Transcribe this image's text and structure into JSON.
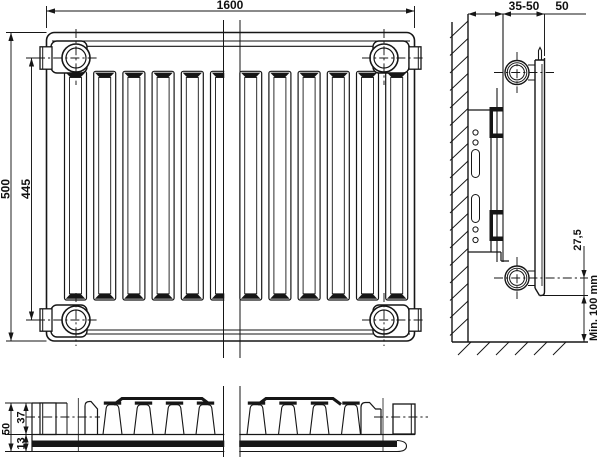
{
  "labels": {
    "front": {
      "width": "1600",
      "height": "500",
      "pipe_centers": "445"
    },
    "side": {
      "wall_gap": "35-50",
      "depth": "50",
      "bottom_offset": "27,5",
      "floor_min": "Min. 100 mm"
    },
    "top": {
      "depth": "50",
      "convector": "37",
      "panel": "13"
    }
  },
  "colors": {
    "line": "#161616",
    "background": "#ffffff"
  }
}
